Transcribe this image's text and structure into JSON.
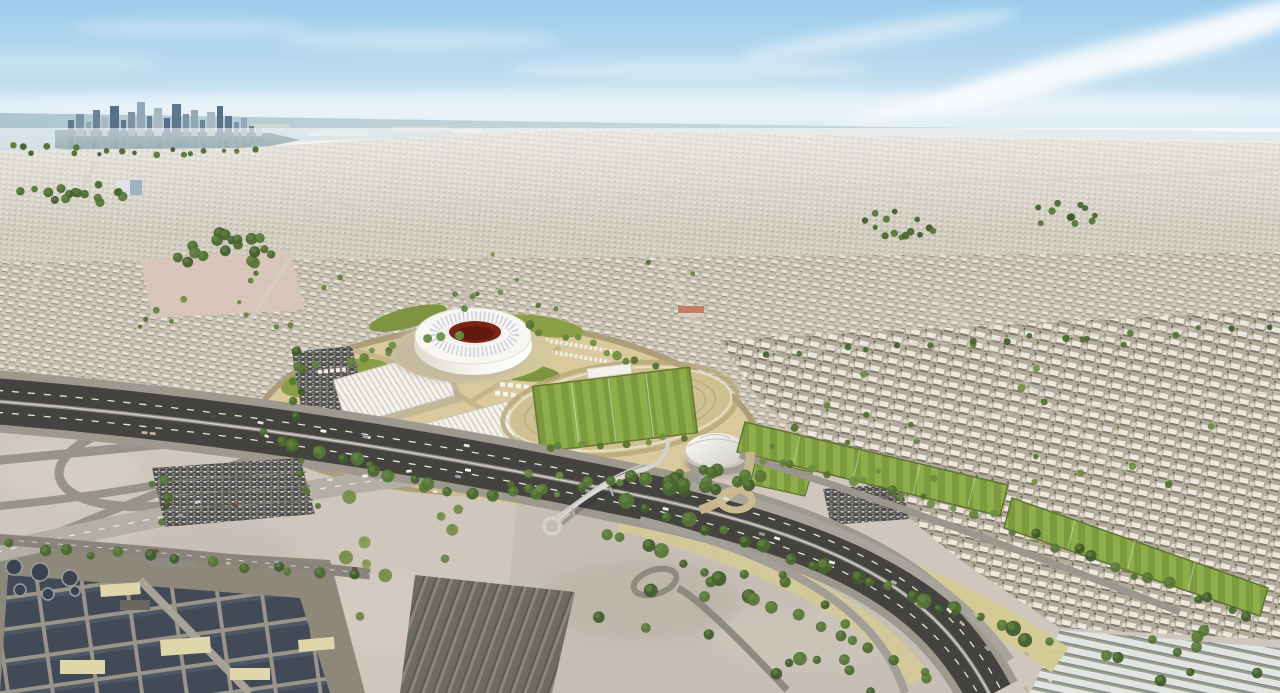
{
  "scene": {
    "setting": "daytime aerial view of a desert city with a round white stadium precinct, training pitches, a major highway, a skyline on the sea horizon and a water-treatment plant in the foreground",
    "elements": [
      "sky",
      "clouds",
      "sea",
      "bay-water",
      "city-skyline",
      "skyline-reflection",
      "coastal-islands",
      "far-city",
      "mid-city",
      "residential-blocks",
      "empty-sand-lot",
      "desert-foreground",
      "center-sand",
      "water-treatment-plant",
      "clarifier-tanks",
      "treatment-basins",
      "plant-buildings",
      "gray-warehouses",
      "white-warehouses",
      "stadium-precinct",
      "stadium",
      "stadium-bowl",
      "canopy-tents",
      "west-parking-lot",
      "foreground-parking-lot",
      "east-parking-lot",
      "training-oval",
      "training-pitches",
      "dome-hall",
      "highway",
      "interchange-ramps",
      "frontage-roads",
      "service-roads",
      "pedestrian-bridge",
      "tree-belts",
      "vehicles",
      "midrise-building",
      "red-roof-building"
    ]
  },
  "colors": {
    "sky-top": "#9cccec",
    "sky-horizon": "#eef4f6",
    "cloud": "#ffffff",
    "sea": "#c3d5da",
    "sea-deep": "#aec6cf",
    "bay-water": "#5d7a88",
    "reflection": "#31505f",
    "skyline-tower": "#6e8499",
    "city-far": "#d0ccc0",
    "city-mid": "#c5beb0",
    "city-near": "#b3ab9d",
    "tree-dark": "#3f5a2b",
    "tree-light": "#62813c",
    "sand-foreground": "#cfc6bd",
    "sand-center": "#c6beb4",
    "sand-pink": "#d9c5ba",
    "sand-yellow": "#d4ca94",
    "plaza": "#d9c99d",
    "lawn": "#8a9f45",
    "pitch-a": "#7d9a3e",
    "pitch-b": "#90ad4c",
    "stadium-white": "#f8f6f0",
    "stadium-shade": "#dedacf",
    "bowl-maroon": "#7e2415",
    "bowl-dark": "#601a0e",
    "tent-white": "#f5f3ee",
    "road-asphalt": "#454340",
    "road-shoulder": "#9d998f",
    "road-light": "#b3afa6",
    "ramp": "#98948b",
    "lane-mark": "#ffffff",
    "basin": "#414a56",
    "plant-ground": "#8e887b",
    "building-beige": "#e0d6ac",
    "warehouse-gray": "#6e6b64",
    "shed-white": "#e2e4e3",
    "parking-dark": "#514e49",
    "bridge-deck": "#dcdad5"
  }
}
